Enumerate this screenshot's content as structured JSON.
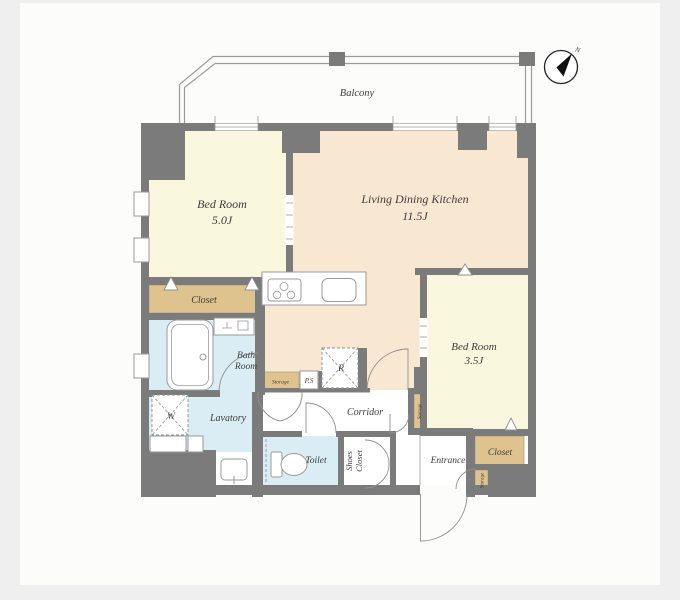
{
  "palette": {
    "background": "#efefef",
    "panel": "#fcfcfb",
    "wall": "#7b7b7b",
    "line": "#9a9a9a",
    "room_cream": "#faf7df",
    "room_peach": "#f9e8d1",
    "room_tan": "#dec38e",
    "room_blue": "#daecf4",
    "text": "#3c3c3c"
  },
  "labels": {
    "balcony": "Balcony",
    "bedroom1_name": "Bed Room",
    "bedroom1_size": "5.0J",
    "ldk_name": "Living Dining Kitchen",
    "ldk_size": "11.5J",
    "bedroom2_name": "Bed Room",
    "bedroom2_size": "3.5J",
    "closet_left": "Closet",
    "closet_right": "Closet",
    "bath_line1": "Bath",
    "bath_line2": "Room",
    "lavatory": "Lavatory",
    "toilet": "Toilet",
    "corridor": "Corridor",
    "entrance": "Entrance",
    "shoes_line1": "Shoes",
    "shoes_line2": "Closet",
    "storage_kitchen": "Storage",
    "storage_hall": "Storage",
    "storage_entrance": "Storage",
    "ps": "P.S",
    "washer": "W",
    "fridge": "R",
    "compass_north": "N"
  }
}
